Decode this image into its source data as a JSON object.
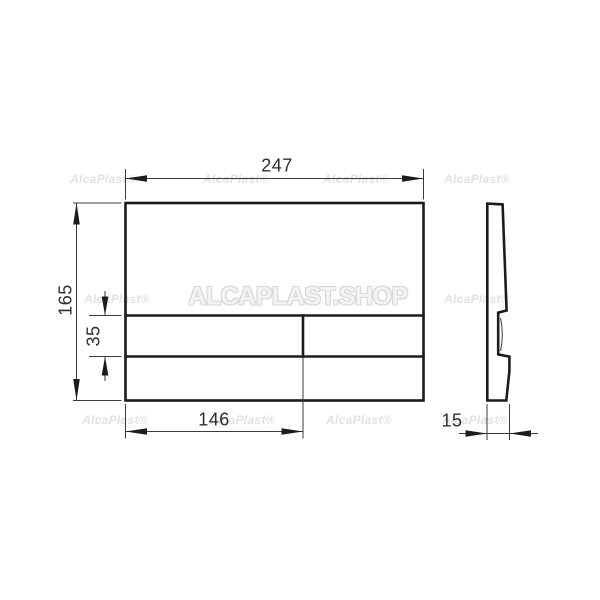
{
  "colors": {
    "background": "#ffffff",
    "line": "#1c1c1c",
    "dimension_text": "#2e2e2e",
    "watermark": "#e2e2e2"
  },
  "watermarks": {
    "large": "ALCAPLAST.SHOP",
    "small": "AlcaPlast®"
  },
  "dimensions": {
    "plate_width": "247",
    "plate_height": "165",
    "button_height": "35",
    "button_width": "146",
    "plate_depth": "15"
  }
}
